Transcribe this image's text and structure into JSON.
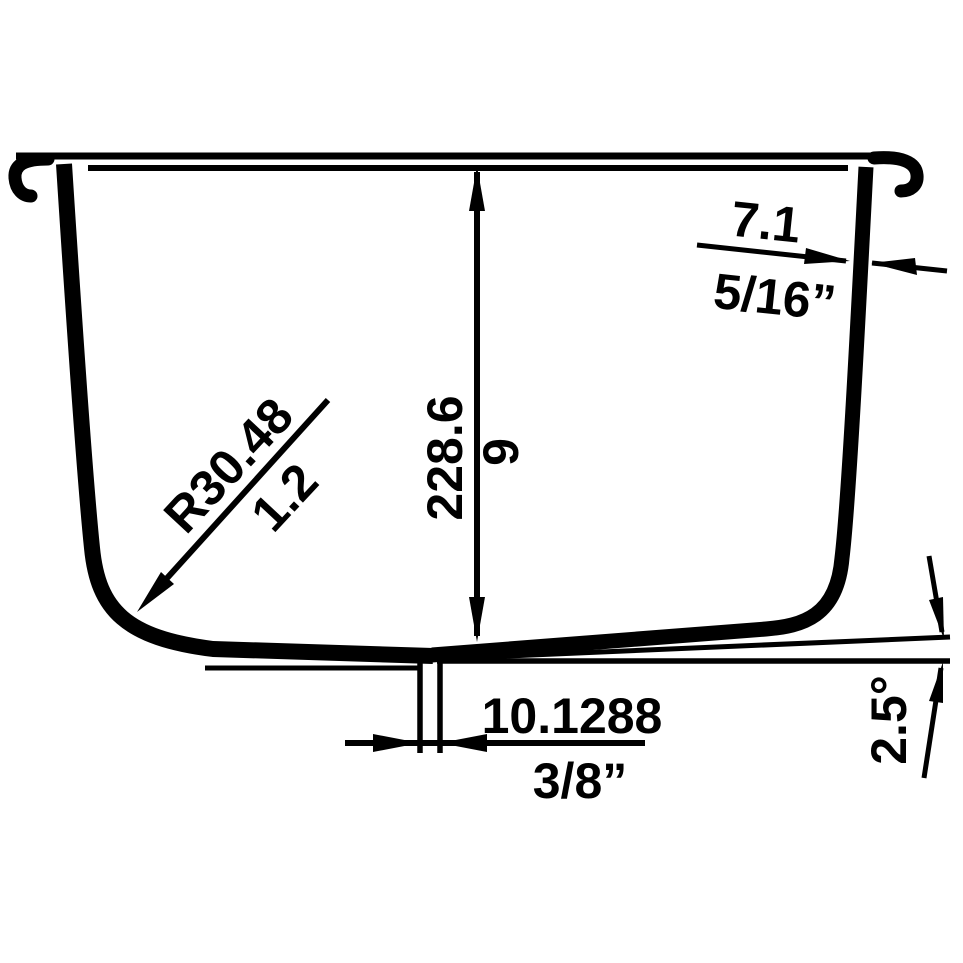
{
  "drawing": {
    "background": "#ffffff",
    "line_color": "#000000",
    "dimensions": {
      "depth": {
        "mm": "228.6",
        "inches": "9"
      },
      "rim_thickness": {
        "mm": "7.1",
        "inches": "5/16”"
      },
      "corner_radius": {
        "mm": "R30.48",
        "inches": "1.2"
      },
      "drain_step": {
        "mm": "10.1288",
        "inches": "3/8”"
      },
      "bottom_slope": {
        "angle": "2.5°"
      }
    }
  }
}
